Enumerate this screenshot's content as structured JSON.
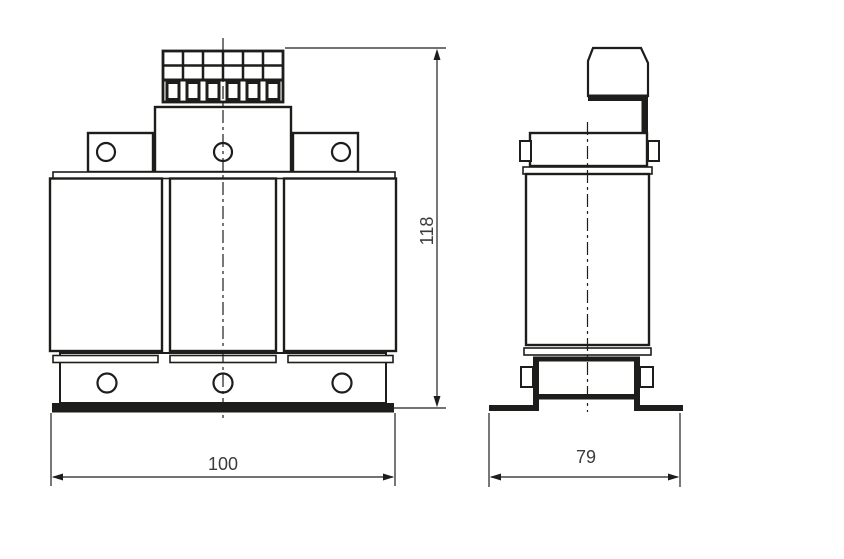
{
  "colors": {
    "line": "#1d1d1b",
    "text": "#3c3c3b",
    "background": "#ffffff"
  },
  "dimensions": {
    "front_width": "100",
    "front_height": "118",
    "side_depth": "79"
  }
}
